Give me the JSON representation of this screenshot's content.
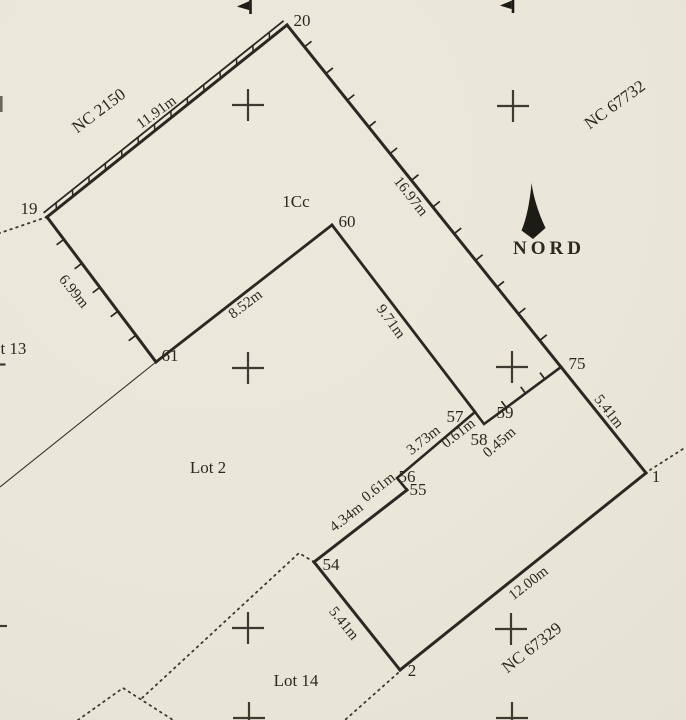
{
  "plan": {
    "north_label": "NORD",
    "unit_label": "1Cc",
    "lots": {
      "lot2": "Lot 2",
      "lot13": "Lot 13",
      "lot14": "Lot 14"
    },
    "adjacent_parcels": {
      "nc2150": "NC 2150",
      "nc67732": "NC 67732",
      "nc67329": "NC 67329"
    },
    "points": {
      "p1": "1",
      "p2": "2",
      "p19": "19",
      "p20": "20",
      "p54": "54",
      "p55": "55",
      "p56": "56",
      "p57": "57",
      "p58": "58",
      "p59": "59",
      "p60": "60",
      "p61": "61",
      "p75": "75"
    },
    "measurements": {
      "m19_20": "11.91m",
      "m20_75": "16.97m",
      "m19_61": "6.99m",
      "m61_60": "8.52m",
      "m60_57": "9.71m",
      "m75_1": "5.41m",
      "m56_57": "3.73m",
      "m57_58": "0.61m",
      "m58_59": "0.45m",
      "m55_56": "0.61m",
      "m54_55": "4.34m",
      "m1_2": "12.00m",
      "m2_54": "5.41m"
    },
    "colors": {
      "paper": "#ebe7d9",
      "ink": "#2b2823"
    }
  }
}
